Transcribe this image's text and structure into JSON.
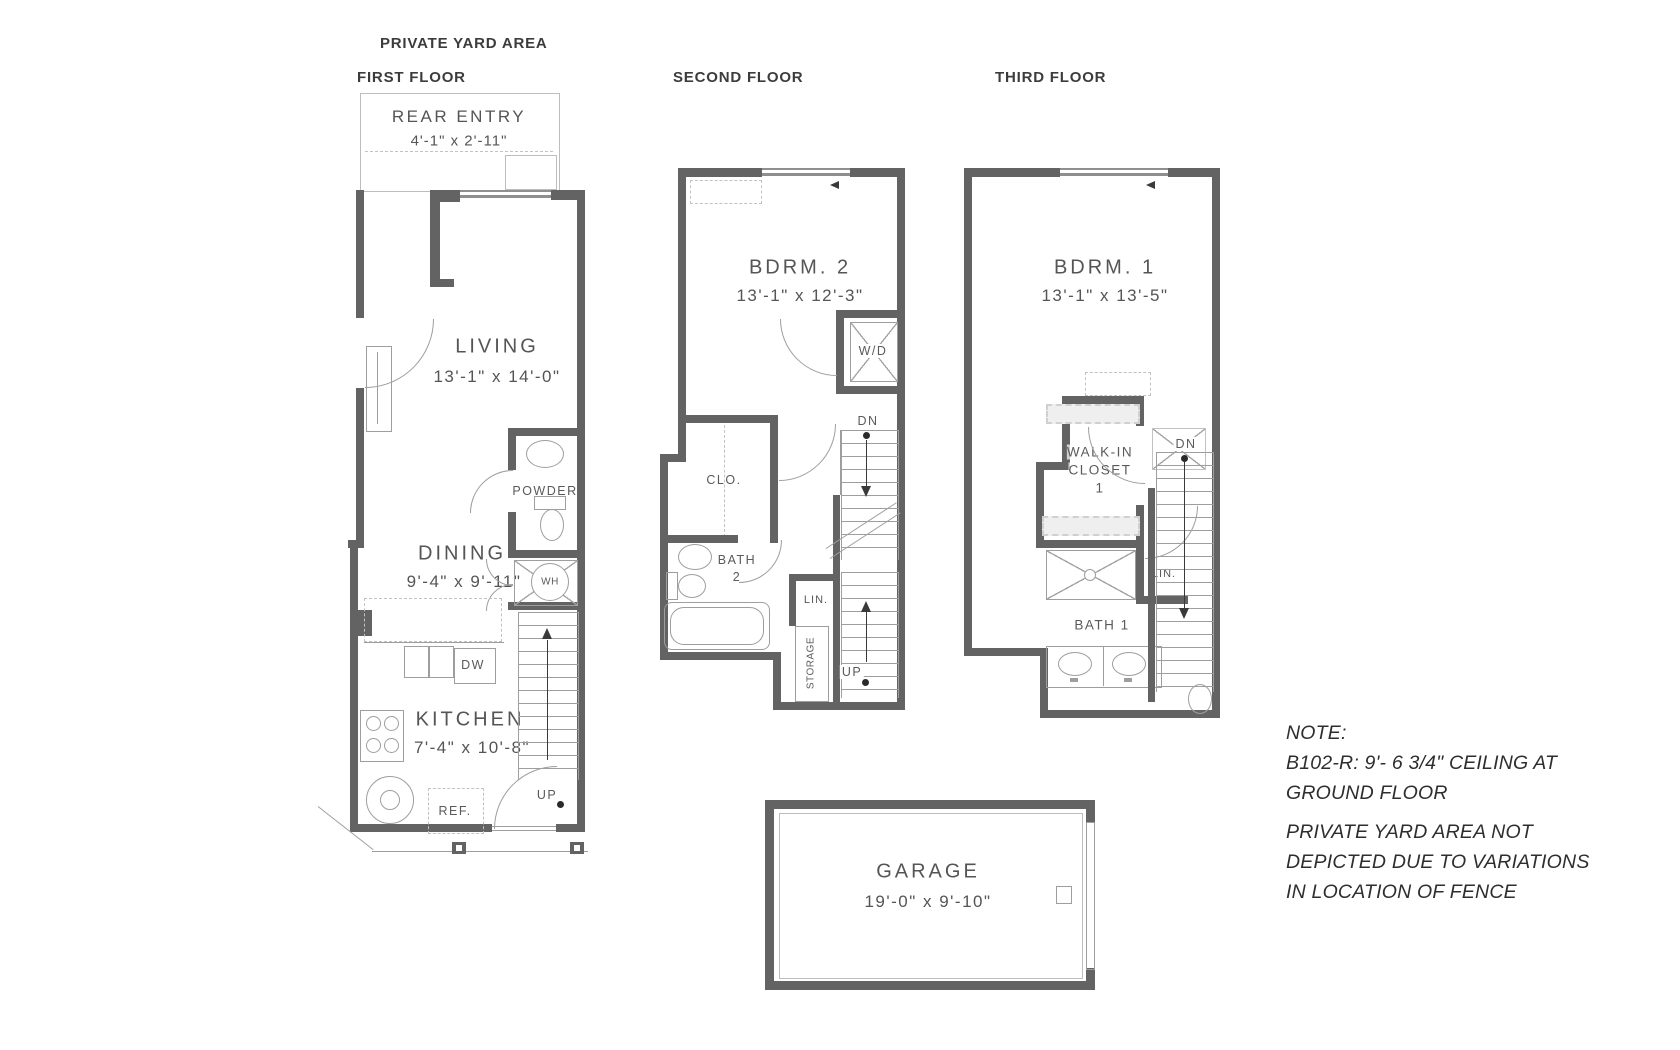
{
  "header": {
    "yard_area_label": "PRIVATE YARD AREA"
  },
  "first_floor": {
    "title": "FIRST FLOOR",
    "rear_entry_name": "REAR ENTRY",
    "rear_entry_dims": "4'-1\" x 2'-11\"",
    "living_name": "LIVING",
    "living_dims": "13'-1\" x 14'-0\"",
    "dining_name": "DINING",
    "dining_dims": "9'-4\" x 9'-11\"",
    "powder_label": "POWDER",
    "water_heater_label": "WH",
    "dishwasher_label": "DW",
    "kitchen_name": "KITCHEN",
    "kitchen_dims": "7'-4\" x 10'-8\"",
    "refrigerator_label": "REF.",
    "stairs_up_label": "UP"
  },
  "second_floor": {
    "title": "SECOND FLOOR",
    "bedroom2_name": "BDRM. 2",
    "bedroom2_dims": "13'-1\" x 12'-3\"",
    "washer_dryer_label": "W/D",
    "stairs_down_label": "DN",
    "closet_label": "CLO.",
    "bath2_name_line1": "BATH",
    "bath2_name_line2": "2",
    "linen_label": "LIN.",
    "storage_label": "STORAGE",
    "stairs_up_label": "UP"
  },
  "third_floor": {
    "title": "THIRD FLOOR",
    "bedroom1_name": "BDRM. 1",
    "bedroom1_dims": "13'-1\" x 13'-5\"",
    "walkin_line1": "WALK-IN",
    "walkin_line2": "CLOSET",
    "walkin_line3": "1",
    "stairs_down_label": "DN",
    "linen_label": "LIN.",
    "bath1_name": "BATH 1"
  },
  "garage": {
    "name": "GARAGE",
    "dims": "19'-0\" x 9'-10\""
  },
  "note": {
    "heading": "NOTE:",
    "ceiling_line1": "B102-R: 9'- 6 3/4\" CEILING AT",
    "ceiling_line2": "GROUND FLOOR",
    "yard_line1": "PRIVATE YARD AREA NOT",
    "yard_line2": "DEPICTED DUE TO VARIATIONS",
    "yard_line3": "IN LOCATION OF FENCE"
  },
  "colors": {
    "wall": "#636363",
    "line": "#9e9e9e",
    "light_line": "#c2c2c2",
    "text": "#4a4a4a"
  }
}
